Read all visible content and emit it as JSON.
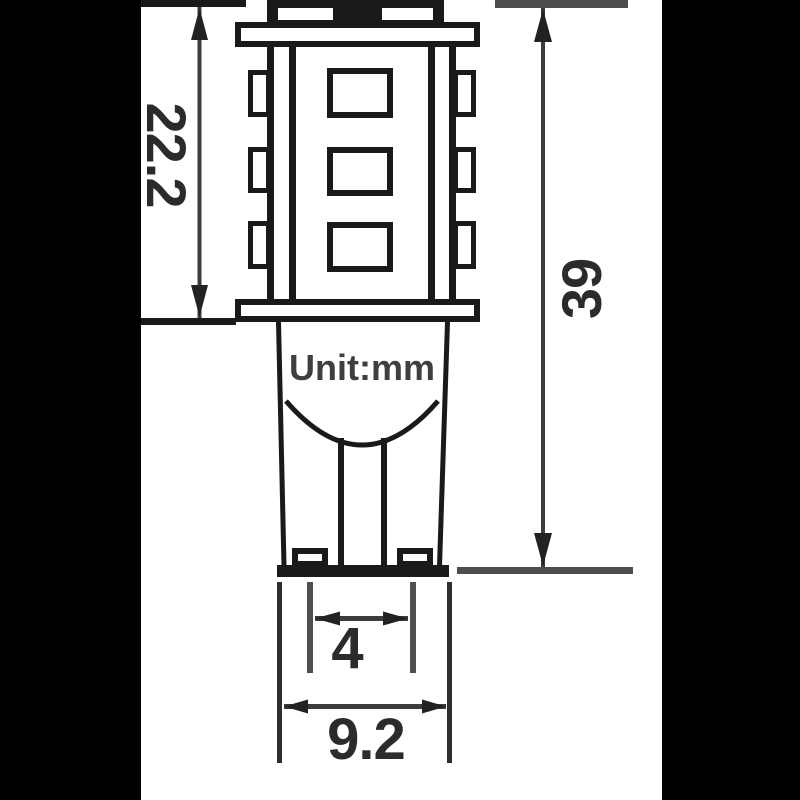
{
  "diagram": {
    "title": "led-bulb-dimension-drawing",
    "unit_label": "Unit:mm",
    "dimensions": {
      "tower_height": "22.2",
      "total_length": "39",
      "contact_width": "4",
      "base_width": "9.2"
    },
    "colors": {
      "background": "#ffffff",
      "letterbox": "#000000",
      "outline": "#1a1a1a",
      "dimension_line": "#3c3c3c",
      "gray_extension": "#4d4d4d",
      "text": "#2b2b2b"
    }
  }
}
